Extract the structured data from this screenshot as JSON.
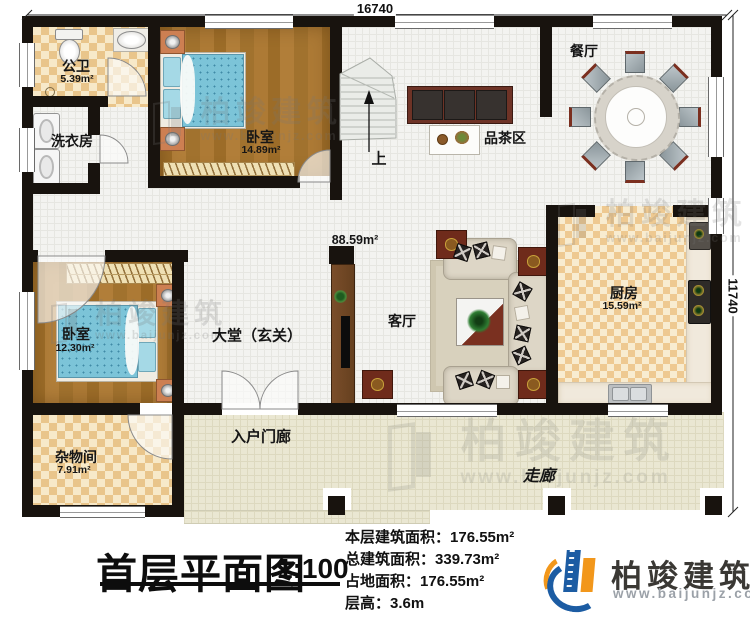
{
  "plan": {
    "dimensions": {
      "top": "16740",
      "right": "11740"
    },
    "open_area_label": "88.59m²",
    "stair_direction": "上",
    "rooms": {
      "bathroom": {
        "name": "公卫",
        "area": "5.39m²"
      },
      "laundry": {
        "name": "洗衣房"
      },
      "bedroom_top": {
        "name": "卧室",
        "area": "14.89m²"
      },
      "dining": {
        "name": "餐厅"
      },
      "tea_area": {
        "name": "品茶区"
      },
      "kitchen": {
        "name": "厨房",
        "area": "15.59m²"
      },
      "living": {
        "name": "客厅"
      },
      "lobby": {
        "name": "大堂（玄关）"
      },
      "bedroom_left": {
        "name": "卧室",
        "area": "12.30m²"
      },
      "storage": {
        "name": "杂物间",
        "area": "7.91m²"
      },
      "porch": {
        "name": "入户门廊"
      },
      "corridor": {
        "name": "走廊"
      }
    }
  },
  "title": {
    "text": "首层平面图",
    "scale": "1:100"
  },
  "stats": [
    {
      "label": "本层建筑面积：",
      "value": "176.55m²"
    },
    {
      "label": "总建筑面积：",
      "value": "339.73m²"
    },
    {
      "label": "占地面积：",
      "value": "176.55m²"
    },
    {
      "label": "层高：",
      "value": "3.6m"
    }
  ],
  "brand": {
    "name": "柏竣建筑",
    "url": "www.baijunjz.com",
    "blue": "#1c5ca3",
    "orange": "#f2971b"
  },
  "watermark": {
    "text": "柏竣建筑",
    "url": "www.baijunjz.com"
  }
}
